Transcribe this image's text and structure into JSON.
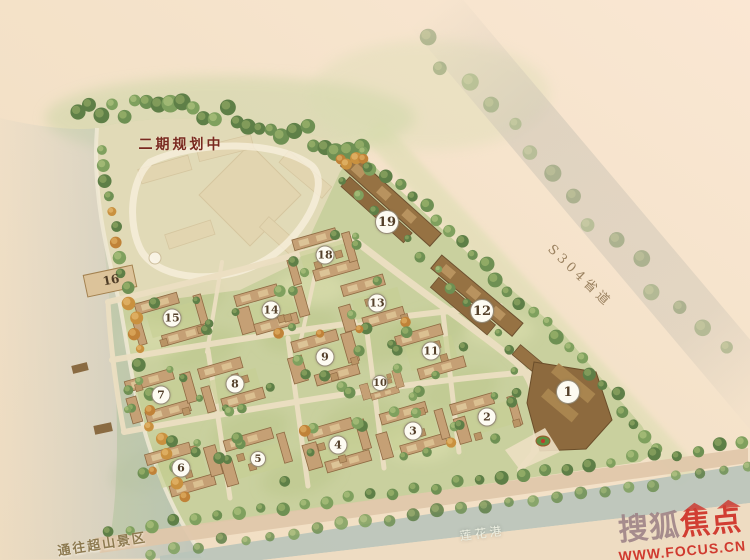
{
  "page": {
    "type": "residential-master-plan"
  },
  "labels": {
    "phase2": "二期规划中",
    "road_s304": "S304省道",
    "to_chaoshan": "通往超山景区",
    "lianhua_port": "莲花港"
  },
  "watermark": {
    "brand_left": "搜狐",
    "brand_right": "焦点",
    "url": "WWW.FOCUS.CN"
  },
  "markers": [
    {
      "num": "1",
      "x": 568,
      "y": 392,
      "size": "big"
    },
    {
      "num": "2",
      "x": 487,
      "y": 417,
      "size": "md"
    },
    {
      "num": "3",
      "x": 413,
      "y": 431,
      "size": "md"
    },
    {
      "num": "4",
      "x": 338,
      "y": 445,
      "size": "md"
    },
    {
      "num": "5",
      "x": 258,
      "y": 459,
      "size": "sm"
    },
    {
      "num": "6",
      "x": 181,
      "y": 468,
      "size": "md"
    },
    {
      "num": "7",
      "x": 161,
      "y": 395,
      "size": "md"
    },
    {
      "num": "8",
      "x": 235,
      "y": 384,
      "size": "md"
    },
    {
      "num": "9",
      "x": 325,
      "y": 357,
      "size": "md"
    },
    {
      "num": "10",
      "x": 380,
      "y": 383,
      "size": "sm"
    },
    {
      "num": "11",
      "x": 431,
      "y": 351,
      "size": "md"
    },
    {
      "num": "12",
      "x": 482,
      "y": 311,
      "size": "big"
    },
    {
      "num": "13",
      "x": 377,
      "y": 303,
      "size": "md"
    },
    {
      "num": "14",
      "x": 271,
      "y": 310,
      "size": "md"
    },
    {
      "num": "15",
      "x": 172,
      "y": 318,
      "size": "md"
    },
    {
      "num": "16",
      "x": 111,
      "y": 280,
      "size": "plain"
    },
    {
      "num": "18",
      "x": 325,
      "y": 255,
      "size": "md"
    },
    {
      "num": "19",
      "x": 387,
      "y": 222,
      "size": "big"
    }
  ],
  "colors": {
    "accent_red": "#ce2d23",
    "phase2_text": "#79291f",
    "road_text": "#9b8260",
    "water": "#bcc6bc"
  }
}
